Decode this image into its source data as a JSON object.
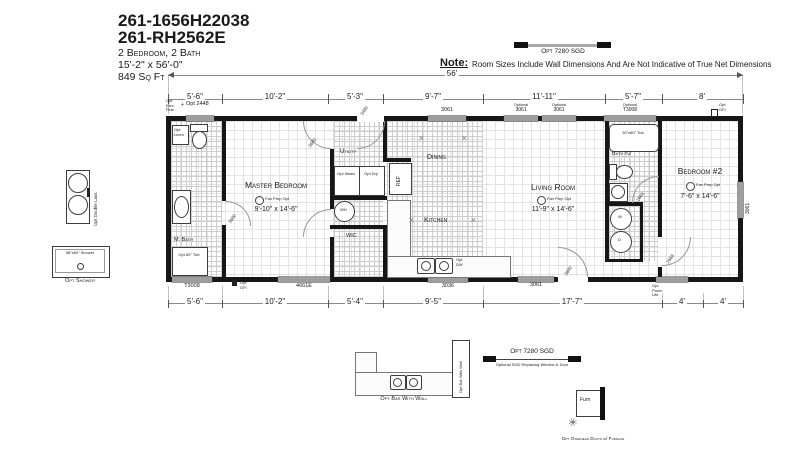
{
  "header": {
    "model1": "261-1656H22038",
    "model2": "261-RH2562E",
    "spec_beds": "2 Bedroom, 2 Bath",
    "spec_size": "15'-2\" x 56'-0\"",
    "spec_area": "849 Sq Ft"
  },
  "note": {
    "label": "Note:",
    "text": "Room Sizes Include Wall Dimensions And Are Not Indicative of True Net Dimensions"
  },
  "opt_sgd_top": "Opt 7280 SGD",
  "opt_sgd_bottom": {
    "title": "Opt 7280 SGD",
    "subtitle": "Optional SGD Replacing Window & Door"
  },
  "dimensions": {
    "overall": "56'",
    "top": [
      "5'-6\"",
      "10'-2\"",
      "5'-3\"",
      "9'-7\"",
      "11'-11\"",
      "5'-7\"",
      "8'"
    ],
    "bottom": [
      "5'-6\"",
      "10'-2\"",
      "5'-4\"",
      "9'-5\"",
      "17'-7\"",
      "4'",
      "4'"
    ]
  },
  "rooms": {
    "master_bedroom": {
      "name": "Master Bedroom",
      "size": "9'-10\" x 14'-6\""
    },
    "living_room": {
      "name": "Living Room",
      "size": "11'-9\" x 14'-6\""
    },
    "bedroom2": {
      "name": "Bedroom #2",
      "size": "7'-6\" x 14'-6\""
    },
    "dining": {
      "name": "Dining"
    },
    "kitchen": {
      "name": "Kitchen"
    },
    "utility": {
      "name": "Utility"
    },
    "wic": {
      "name": "WIC"
    },
    "m_bath": {
      "name": "M. Bath"
    },
    "bath2": {
      "name": "Bath #2"
    }
  },
  "annotations": {
    "fan_prep": "Fan Prep Opt"
  },
  "windows": {
    "opt_elec": "Opt Elec Flue",
    "plus": "+",
    "opt2448": "Opt 2448",
    "w3061_top": "3061",
    "optional_label": "Optional",
    "opt3061_size": "3061",
    "optT3008_size": "T3008",
    "t3008": "T3008",
    "w4661e": "4661E",
    "w3036": "3036",
    "w3061_bottom": "3061",
    "w3061_right": "3061"
  },
  "doors": {
    "front": "3480",
    "mbath": "3680",
    "master": "3680",
    "rear": "3680",
    "bath2": "2668",
    "bedroom2": "2668"
  },
  "fixtures": {
    "opt_linen": "Opt Linen",
    "opt_wash": "Opt Wash",
    "opt_dry": "Opt Dry",
    "opt_dw": "Opt DW",
    "ref": "REF",
    "wh": "WH",
    "wd_w": "W",
    "wd_d": "D",
    "tub2": "30\"x60\" Tub",
    "mtub": "Opt 60\" Tub",
    "gfi": "Opt GFI",
    "porch": "Opt Porch Lite"
  },
  "options": {
    "double_lavs": "Opt Double Lavs",
    "shower_size": "36\"x60\" Shower",
    "shower": "Opt Shower",
    "bar": "Opt Bar With Wall",
    "furn": "Furn",
    "furn_note": "Opt Overhead Ducts w/ Furnace"
  }
}
